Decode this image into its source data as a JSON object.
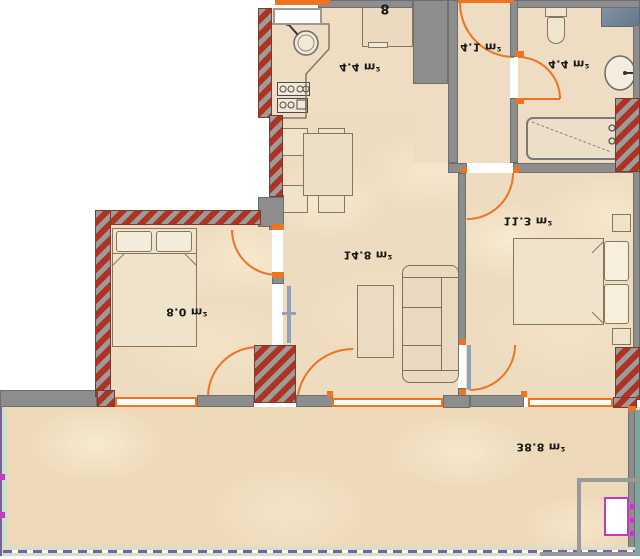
{
  "plan": {
    "title": "apartment-floor-plan",
    "orientation": "flipped-vertically",
    "rooms": [
      {
        "id": "kitchen",
        "area": "4.4 m²"
      },
      {
        "id": "hall",
        "area": "4.1 m²"
      },
      {
        "id": "bathroom",
        "area": "4.4 m²"
      },
      {
        "id": "living-room",
        "area": "14.8 m²"
      },
      {
        "id": "bedroom-right",
        "area": "11.3 m²"
      },
      {
        "id": "bedroom-left",
        "area": "8.0 m²"
      },
      {
        "id": "terrace",
        "area": "38.8 m²"
      }
    ],
    "symbols": {
      "boiler": "8"
    },
    "fixtures": [
      "kitchen-sink",
      "stove",
      "oven-cabinet",
      "dining-table",
      "dining-chairs",
      "sofa",
      "coffee-table",
      "double-bed",
      "single-bed",
      "nightstands",
      "toilet",
      "washbasin",
      "bathtub",
      "shower-shelf"
    ],
    "colors": {
      "wall_gray": "#8d8d8d",
      "hatch_red": "#ae3322",
      "door_orange": "#ef7320",
      "floor_tan": "#eeddc3",
      "leaf_blue": "#8fa3b8",
      "terrace_edge_purple": "#7b5ea7",
      "terrace_edge_green": "#d3e0c9",
      "marker_magenta": "#c23ac2",
      "teal_strip": "#7aa79e",
      "shelf_blue": "#7d8fa0"
    }
  }
}
